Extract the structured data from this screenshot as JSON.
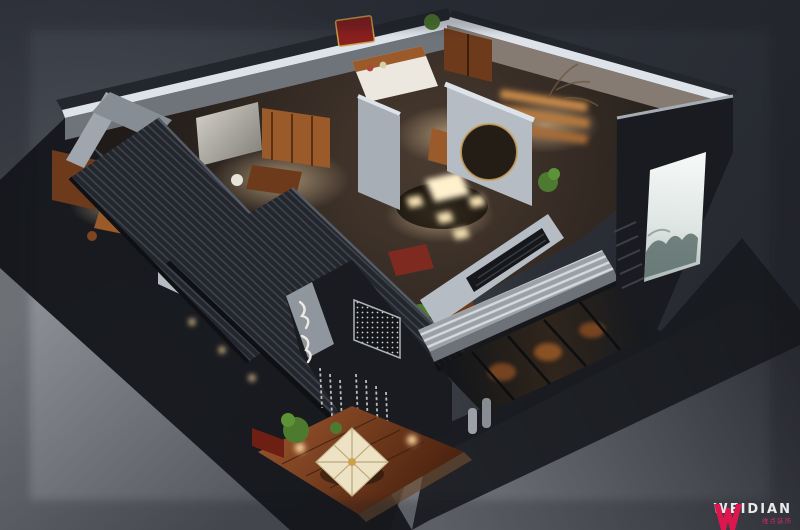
{
  "watermark": {
    "brand": "WEIDIAN",
    "sub_brand": "维点装饰",
    "monogram": "W"
  },
  "palette": {
    "background_top": "#363a44",
    "background_bottom": "#23262c",
    "ground_light": "#8b8f94",
    "ground_dark": "#2c2f35",
    "shadow_dark": "#14161a",
    "roof_slate": "#23262d",
    "roof_stripe": "#3f444d",
    "wall_light": "#b6bcc3",
    "wall_top_edge": "#dde3e9",
    "wall_shadow": "#6f747b",
    "exterior_dark": "#191b20",
    "wood_warm": "#9a5a2a",
    "wood_deep": "#6e3a1c",
    "lacquer_red": "#7e2a20",
    "glow_warm": "#ffd9a0",
    "table_glow": "#fff1cd",
    "plant_green": "#4e7a2f",
    "poster_white": "#f2f5f4",
    "ink_wash": "#5d6e6c",
    "parasol_cream": "#eee2c4",
    "deck_red": "#7c3a1e",
    "brand_pink": "#e5154f"
  }
}
